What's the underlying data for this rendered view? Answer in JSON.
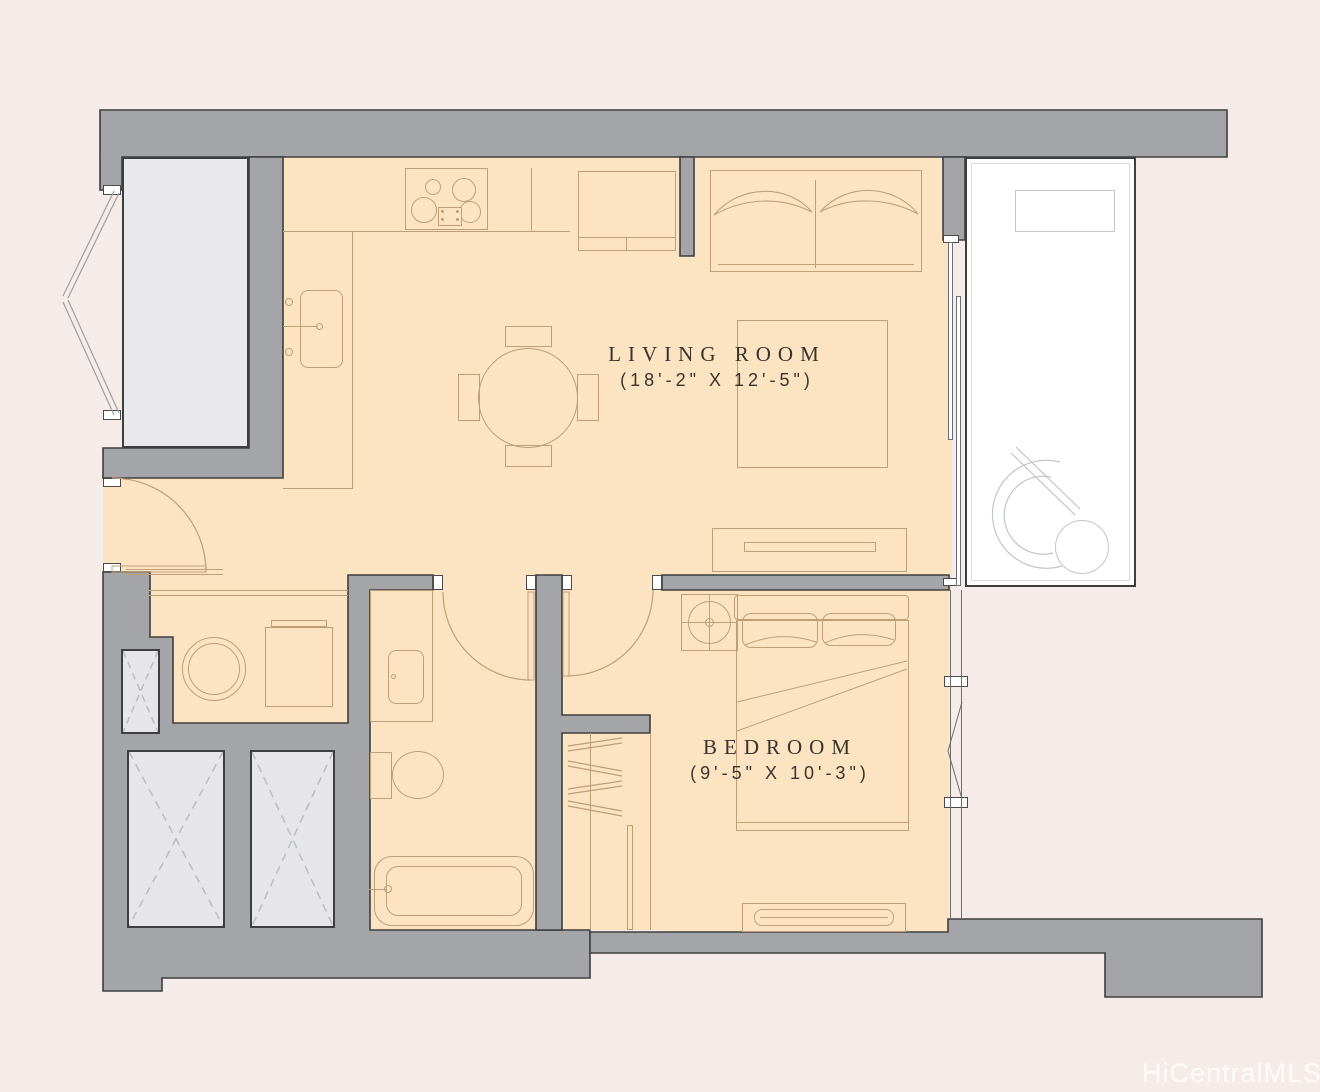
{
  "page": {
    "type": "residential-floor-plan"
  },
  "rooms": [
    {
      "name": "LIVING ROOM",
      "dims": "(18'-2\" X 12'-5\")"
    },
    {
      "name": "BEDROOM",
      "dims": "(9'-5\" X 10'-3\")"
    }
  ],
  "watermark": "HiCentralMLS",
  "colors": {
    "background": "#f5ebe8",
    "wall_fill": "#a3a5a8",
    "wall_outline": "#3e3e3e",
    "floor_fill": "#fce4c3",
    "gray_floor": "#e9e9ec",
    "shaft_fill": "#e6e6e9",
    "shaft_dash": "#b9bdc6",
    "furniture_line": "#bf9e78",
    "gray_line": "#c2c5c9",
    "dark_line": "#6b6e72",
    "label_text": "#3a332e",
    "watermark_text": "#ffffff"
  },
  "furniture": [
    "stove",
    "kitchen-sink",
    "refrigerator",
    "dining-table",
    "dining-chair",
    "sofa",
    "area-rug",
    "tv-console",
    "washer",
    "dryer",
    "bathroom-vanity",
    "bathroom-sink",
    "toilet",
    "bathtub",
    "bed",
    "pillow",
    "dresser",
    "ceiling-fan",
    "closet-hangers",
    "lounge-chair",
    "patio-side-table",
    "patio-table",
    "elevator-shaft",
    "utility-shaft",
    "stairwell"
  ]
}
